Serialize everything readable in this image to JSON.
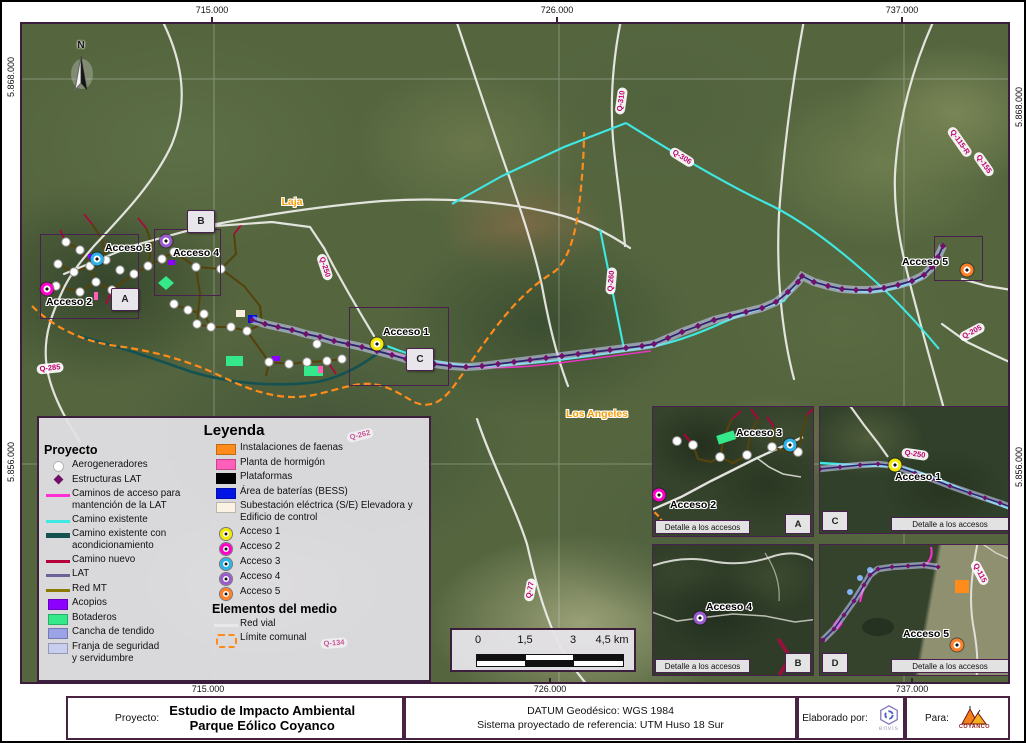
{
  "frame": {
    "coords_top": [
      "715.000",
      "726.000",
      "737.000"
    ],
    "coords_bottom": [
      "715.000",
      "726.000",
      "737.000"
    ],
    "coords_left": [
      "5.868.000",
      "5.856.000"
    ],
    "coords_right": [
      "5.868.000",
      "5.856.000"
    ]
  },
  "map": {
    "north_label": "N",
    "city_labels": [
      {
        "text": "Laja",
        "x": 270,
        "y": 178
      },
      {
        "text": "Los Angeles",
        "x": 575,
        "y": 390
      }
    ],
    "road_labels": [
      {
        "text": "Q-310",
        "c": "map",
        "x": 599,
        "y": 77,
        "rot": -82
      },
      {
        "text": "Q-306",
        "c": "map",
        "x": 660,
        "y": 133,
        "rot": 32
      },
      {
        "text": "Q-250",
        "c": "map",
        "x": 303,
        "y": 243,
        "rot": 72
      },
      {
        "text": "Q-260",
        "c": "map",
        "x": 589,
        "y": 257,
        "rot": -85
      },
      {
        "text": "Q-285",
        "c": "map",
        "x": 28,
        "y": 344,
        "rot": -6
      },
      {
        "text": "Q-262",
        "c": "map",
        "x": 338,
        "y": 411,
        "rot": -14,
        "opacity": 0.6
      },
      {
        "text": "Q-134",
        "c": "map",
        "x": 312,
        "y": 619,
        "rot": -4,
        "opacity": 0.6
      },
      {
        "text": "Q-77",
        "c": "map",
        "x": 508,
        "y": 566,
        "rot": -80
      },
      {
        "text": "Q-205",
        "c": "map",
        "x": 950,
        "y": 308,
        "rot": -28
      },
      {
        "text": "Q-115-R",
        "c": "map",
        "x": 938,
        "y": 118,
        "rot": 55
      },
      {
        "text": "Q-155",
        "c": "map",
        "x": 962,
        "y": 140,
        "rot": 55
      },
      {
        "text": "Q-250",
        "c": "C",
        "x": 95,
        "y": 47,
        "rot": 8
      },
      {
        "text": "Q-115",
        "c": "D",
        "x": 160,
        "y": 28,
        "rot": 62
      }
    ],
    "access_points": [
      {
        "label": "Acceso 1",
        "color": "#f2e800",
        "c": "map",
        "mx": 355,
        "my": 320,
        "lx": 384,
        "ly": 308
      },
      {
        "label": "Acceso 2",
        "color": "#ff00cc",
        "c": "map",
        "mx": 25,
        "my": 265,
        "lx": 47,
        "ly": 278
      },
      {
        "label": "Acceso 3",
        "color": "#2bb2e8",
        "c": "map",
        "mx": 75,
        "my": 235,
        "lx": 106,
        "ly": 224
      },
      {
        "label": "Acceso 4",
        "color": "#9b59d0",
        "c": "map",
        "mx": 144,
        "my": 217,
        "lx": 174,
        "ly": 229
      },
      {
        "label": "Acceso 5",
        "color": "#ff7f27",
        "c": "map",
        "mx": 945,
        "my": 246,
        "lx": 903,
        "ly": 238
      },
      {
        "label": "Acceso 2",
        "color": "#ff00cc",
        "c": "A",
        "mx": 6,
        "my": 88,
        "lx": 40,
        "ly": 98
      },
      {
        "label": "Acceso 3",
        "color": "#2bb2e8",
        "c": "A",
        "mx": 137,
        "my": 38,
        "lx": 106,
        "ly": 26
      },
      {
        "label": "Acceso 4",
        "color": "#9b59d0",
        "c": "B",
        "mx": 47,
        "my": 73,
        "lx": 76,
        "ly": 62
      },
      {
        "label": "Acceso 1",
        "color": "#f2e800",
        "c": "C",
        "mx": 75,
        "my": 58,
        "lx": 98,
        "ly": 70
      },
      {
        "label": "Acceso 5",
        "color": "#ff7f27",
        "c": "D",
        "mx": 137,
        "my": 100,
        "lx": 106,
        "ly": 89
      }
    ],
    "extent_boxes": [
      {
        "l": "A",
        "x": 18,
        "y": 210,
        "w": 97,
        "h": 83,
        "bx": 89,
        "by": 264
      },
      {
        "l": "B",
        "x": 132,
        "y": 205,
        "w": 65,
        "h": 65,
        "bx": 165,
        "by": 186
      },
      {
        "l": "C",
        "x": 327,
        "y": 283,
        "w": 98,
        "h": 77,
        "bx": 384,
        "by": 324
      },
      {
        "l": "D",
        "x": 912,
        "y": 212,
        "w": 47,
        "h": 43
      }
    ],
    "turbines": [
      [
        44,
        218
      ],
      [
        58,
        226
      ],
      [
        36,
        240
      ],
      [
        52,
        248
      ],
      [
        68,
        242
      ],
      [
        84,
        236
      ],
      [
        98,
        246
      ],
      [
        74,
        258
      ],
      [
        90,
        266
      ],
      [
        58,
        268
      ],
      [
        34,
        262
      ],
      [
        112,
        250
      ],
      [
        126,
        242
      ],
      [
        140,
        235
      ],
      [
        152,
        228
      ],
      [
        174,
        243
      ],
      [
        199,
        245
      ],
      [
        152,
        280
      ],
      [
        166,
        286
      ],
      [
        182,
        290
      ],
      [
        175,
        300
      ],
      [
        189,
        303
      ],
      [
        209,
        303
      ],
      [
        225,
        307
      ],
      [
        247,
        338
      ],
      [
        267,
        340
      ],
      [
        285,
        338
      ],
      [
        305,
        337
      ],
      [
        295,
        320
      ],
      [
        320,
        335
      ]
    ],
    "lat_points": [
      [
        230,
        296
      ],
      [
        243,
        300
      ],
      [
        256,
        303
      ],
      [
        270,
        306
      ],
      [
        284,
        310
      ],
      [
        298,
        313
      ],
      [
        312,
        317
      ],
      [
        326,
        320
      ],
      [
        340,
        323
      ],
      [
        355,
        327
      ],
      [
        370,
        331
      ],
      [
        384,
        335
      ],
      [
        398,
        338
      ],
      [
        412,
        340
      ],
      [
        428,
        342
      ],
      [
        444,
        343
      ],
      [
        460,
        342
      ],
      [
        476,
        340
      ],
      [
        492,
        338
      ],
      [
        508,
        336
      ],
      [
        524,
        334
      ],
      [
        540,
        332
      ],
      [
        556,
        330
      ],
      [
        572,
        328
      ],
      [
        588,
        326
      ],
      [
        604,
        324
      ],
      [
        620,
        322
      ],
      [
        632,
        320
      ],
      [
        646,
        314
      ],
      [
        660,
        308
      ],
      [
        676,
        302
      ],
      [
        692,
        296
      ],
      [
        708,
        292
      ],
      [
        724,
        288
      ],
      [
        740,
        284
      ],
      [
        754,
        278
      ],
      [
        766,
        268
      ],
      [
        776,
        258
      ],
      [
        780,
        252
      ],
      [
        792,
        258
      ],
      [
        806,
        262
      ],
      [
        820,
        265
      ],
      [
        834,
        266
      ],
      [
        848,
        266
      ],
      [
        862,
        264
      ],
      [
        876,
        261
      ],
      [
        890,
        257
      ],
      [
        902,
        251
      ],
      [
        910,
        243
      ],
      [
        916,
        233
      ],
      [
        921,
        222
      ]
    ],
    "insets": [
      {
        "badge": "A",
        "caption": "Detalle a los accesos"
      },
      {
        "badge": "C",
        "caption": "Detalle a los accesos",
        "lat": [
          [
            0,
            62
          ],
          [
            20,
            60
          ],
          [
            40,
            58
          ],
          [
            58,
            57
          ],
          [
            75,
            59
          ],
          [
            95,
            66
          ],
          [
            112,
            72
          ],
          [
            130,
            79
          ],
          [
            150,
            86
          ],
          [
            165,
            91
          ],
          [
            180,
            96
          ],
          [
            193,
            101
          ]
        ]
      },
      {
        "badge": "B",
        "caption": "Detalle a los accesos"
      },
      {
        "badge": "D",
        "caption": "Detalle a los accesos",
        "lat": [
          [
            3,
            95
          ],
          [
            14,
            84
          ],
          [
            24,
            70
          ],
          [
            34,
            56
          ],
          [
            44,
            40
          ],
          [
            50,
            30
          ],
          [
            58,
            24
          ],
          [
            72,
            22
          ],
          [
            88,
            21
          ],
          [
            104,
            20
          ],
          [
            118,
            22
          ]
        ]
      }
    ]
  },
  "legend": {
    "title": "Leyenda",
    "left_header": "Proyecto",
    "left_items": [
      {
        "sym": "dot",
        "label": "Aerogeneradores"
      },
      {
        "sym": "diamond",
        "label": "Estructuras LAT"
      },
      {
        "sym": "line",
        "color": "#ff2fd6",
        "label": "Caminos de acceso para\nmantención de la LAT"
      },
      {
        "sym": "line",
        "color": "#3fe8e2",
        "label": "Camino existente"
      },
      {
        "sym": "line-thick",
        "color": "#145252",
        "label": "Camino existente con\nacondicionamiento"
      },
      {
        "sym": "line",
        "color": "#b5003c",
        "label": "Camino nuevo"
      },
      {
        "sym": "line",
        "color": "#6b6296",
        "label": "LAT"
      },
      {
        "sym": "line",
        "color": "#8a7a00",
        "label": "Red MT"
      },
      {
        "sym": "rect",
        "color": "#8c00ff",
        "label": "Acopios"
      },
      {
        "sym": "rect",
        "color": "#35e98a",
        "label": "Botaderos"
      },
      {
        "sym": "rect",
        "color": "#9aa3e8",
        "label": "Cancha de tendido"
      },
      {
        "sym": "rect",
        "color": "#c9cdf0",
        "label": "Franja de seguridad\ny servidumbre"
      }
    ],
    "right_items": [
      {
        "sym": "rect",
        "color": "#ff8c1a",
        "label": "Instalaciones de faenas"
      },
      {
        "sym": "rect",
        "color": "#ff5fb8",
        "label": "Planta de hormigón"
      },
      {
        "sym": "rect",
        "color": "#000000",
        "label": "Plataformas"
      },
      {
        "sym": "rect",
        "color": "#0014e6",
        "label": "Área de baterías (BESS)"
      },
      {
        "sym": "rect",
        "color": "#faf3e4",
        "label": "Subestación eléctrica (S/E) Elevadora y\nEdificio de control"
      },
      {
        "sym": "access",
        "color": "#f2e800",
        "label": "Acceso 1"
      },
      {
        "sym": "access",
        "color": "#ff00cc",
        "label": "Acceso 2"
      },
      {
        "sym": "access",
        "color": "#2bb2e8",
        "label": "Acceso 3"
      },
      {
        "sym": "access",
        "color": "#9b59d0",
        "label": "Acceso 4"
      },
      {
        "sym": "access",
        "color": "#ff7f27",
        "label": "Acceso 5"
      }
    ],
    "mid_header": "Elementos del medio",
    "env_items": [
      {
        "sym": "line",
        "color": "#e8e8e8",
        "label": "Red vial"
      },
      {
        "sym": "dashed-rect",
        "color": "#ff8c1a",
        "label": "Límite comunal"
      }
    ]
  },
  "scalebar": {
    "labels": [
      "0",
      "1,5",
      "3",
      "4,5 km"
    ]
  },
  "footer": {
    "project_label": "Proyecto:",
    "project_title_1": "Estudio de Impacto Ambiental",
    "project_title_2": "Parque Eólico Coyanco",
    "datum_1": "DATUM Geodésico: WGS 1984",
    "datum_2": "Sistema proyectado de referencia: UTM Huso 18 Sur",
    "made_by_label": "Elaborado por:",
    "made_by_name": "envis",
    "for_label": "Para:",
    "for_name": "COYANCO"
  }
}
